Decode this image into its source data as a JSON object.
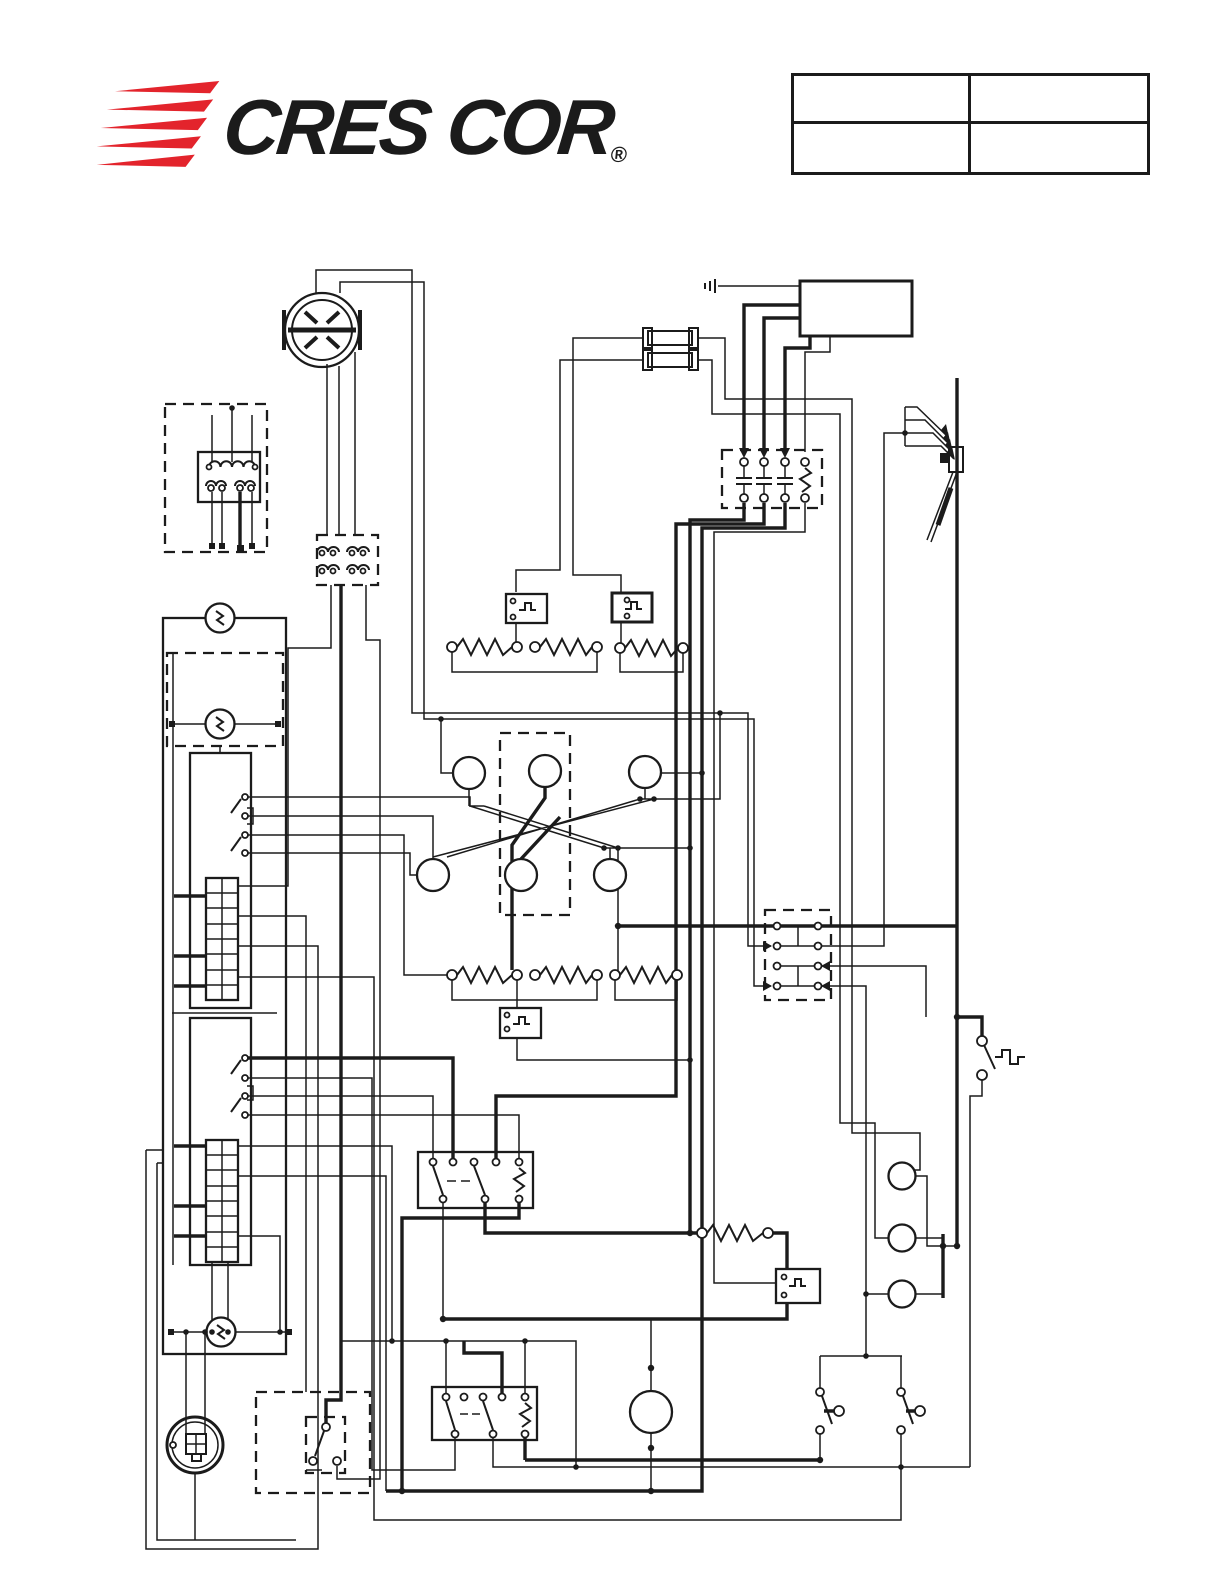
{
  "page": {
    "background": "#ffffff",
    "ink_color": "#1b1b1b"
  },
  "header": {
    "logo": {
      "text": "CRES COR",
      "registered_mark": "®",
      "speed_line_color": "#E3242C",
      "text_color": "#1b1b1b"
    },
    "info_table": {
      "rows": [
        [
          "",
          ""
        ],
        [
          "",
          ""
        ]
      ]
    }
  },
  "diagram": {
    "type": "wiring-schematic",
    "ink_color": "#1b1b1b",
    "text_labels": [],
    "components": [
      "twist-lock-connector",
      "control-board",
      "ground-symbol",
      "fuse-1",
      "fuse-2",
      "main-contactor",
      "power-cord-assembly",
      "transformer-module",
      "plug-connector-block",
      "left-enclosure",
      "circuit-breaker-1",
      "circuit-breaker-2",
      "circuit-breaker-3",
      "relay-switch-block-1",
      "relay-switch-block-2",
      "terminal-block-1",
      "terminal-block-2",
      "receptacle",
      "master-switch",
      "thermostat-1",
      "thermostat-2",
      "thermostat-3",
      "thermostat-4",
      "heating-element-1",
      "heating-element-2",
      "heating-element-3",
      "heating-element-4",
      "lamp-cluster",
      "junction-block",
      "contactor-relay-1",
      "contactor-relay-2",
      "resistor-coil",
      "motor",
      "door-switch-1",
      "door-switch-2",
      "limit-switch",
      "indicator-light-1",
      "indicator-light-2",
      "indicator-light-3"
    ]
  }
}
